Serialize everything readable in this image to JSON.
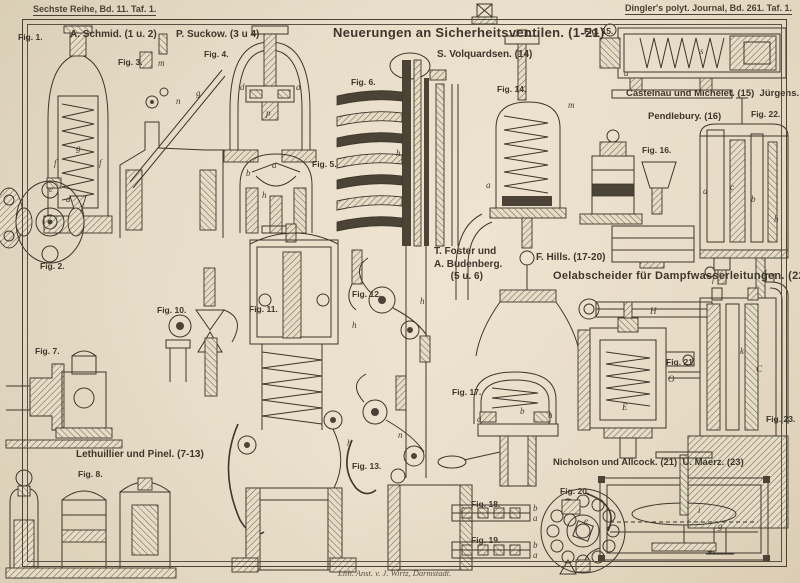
{
  "plate": {
    "margin": {
      "series_label": "Sechste Reihe, Bd. 11. Taf. 1.",
      "journal_label": "Dingler's polyt. Journal, Bd. 261. Taf. 1.",
      "credit": "Lith. Anst. v. J. Wirtz, Darmstadt."
    },
    "titles": [
      {
        "text": "Neuerungen an Sicherheitsventilen. (1-21)",
        "x": 333,
        "y": 25,
        "size": 13
      },
      {
        "text": "Oelabscheider für Dampfwasserleitungen. (22 u. 23)",
        "x": 553,
        "y": 270,
        "size": 11
      }
    ],
    "inventors": [
      {
        "text": "A. Schmid. (1 u. 2)",
        "x": 70,
        "y": 29
      },
      {
        "text": "P. Suckow. (3 u 4)",
        "x": 176,
        "y": 29
      },
      {
        "text": "S. Volquardsen. (14)",
        "x": 437,
        "y": 49
      },
      {
        "text": "Castelnau und Michelet. (15)  Jürgens. (22)",
        "x": 626,
        "y": 88,
        "size": 9.5
      },
      {
        "text": "Pendlebury. (16)",
        "x": 648,
        "y": 111,
        "size": 9.5
      },
      {
        "text": "T. Foster und\nA. Budenberg.\n      (5 u. 6)",
        "x": 434,
        "y": 246
      },
      {
        "text": "F. Hills. (17-20)",
        "x": 536,
        "y": 252
      },
      {
        "text": "Lethuillier und Pinel. (7-13)",
        "x": 76,
        "y": 449
      },
      {
        "text": "Nicholson und Allcock. (21)  U. Maerz. (23)",
        "x": 553,
        "y": 457,
        "size": 9.5
      }
    ],
    "figures": [
      {
        "text": "Fig. 1.",
        "x": 18,
        "y": 32
      },
      {
        "text": "Fig. 2.",
        "x": 40,
        "y": 261
      },
      {
        "text": "Fig. 3.",
        "x": 118,
        "y": 57
      },
      {
        "text": "Fig. 4.",
        "x": 204,
        "y": 49
      },
      {
        "text": "Fig. 5.",
        "x": 312,
        "y": 159
      },
      {
        "text": "Fig. 6.",
        "x": 351,
        "y": 77
      },
      {
        "text": "Fig. 7.",
        "x": 35,
        "y": 346
      },
      {
        "text": "Fig. 8.",
        "x": 78,
        "y": 469
      },
      {
        "text": "Fig. 10.",
        "x": 157,
        "y": 305
      },
      {
        "text": "Fig. 11.",
        "x": 249,
        "y": 304
      },
      {
        "text": "Fig. 12.",
        "x": 352,
        "y": 289
      },
      {
        "text": "Fig. 13.",
        "x": 352,
        "y": 461
      },
      {
        "text": "Fig. 14.",
        "x": 497,
        "y": 84
      },
      {
        "text": "Fig. 15.",
        "x": 584,
        "y": 26
      },
      {
        "text": "Fig. 16.",
        "x": 642,
        "y": 145
      },
      {
        "text": "Fig. 17.",
        "x": 452,
        "y": 387
      },
      {
        "text": "Fig. 18.",
        "x": 471,
        "y": 499
      },
      {
        "text": "Fig. 19.",
        "x": 471,
        "y": 535
      },
      {
        "text": "Fig. 20.",
        "x": 560,
        "y": 486
      },
      {
        "text": "Fig. 21.",
        "x": 666,
        "y": 357
      },
      {
        "text": "Fig. 22.",
        "x": 751,
        "y": 109
      },
      {
        "text": "Fig. 23.",
        "x": 766,
        "y": 414
      }
    ],
    "part_letters": [
      {
        "text": "g",
        "x": 76,
        "y": 143
      },
      {
        "text": "f",
        "x": 54,
        "y": 158
      },
      {
        "text": "f",
        "x": 99,
        "y": 158
      },
      {
        "text": "e",
        "x": 49,
        "y": 184
      },
      {
        "text": "d",
        "x": 66,
        "y": 194
      },
      {
        "text": "m",
        "x": 158,
        "y": 58
      },
      {
        "text": "n",
        "x": 176,
        "y": 96
      },
      {
        "text": "g",
        "x": 196,
        "y": 88
      },
      {
        "text": "d",
        "x": 240,
        "y": 82
      },
      {
        "text": "d",
        "x": 296,
        "y": 82
      },
      {
        "text": "p",
        "x": 266,
        "y": 108
      },
      {
        "text": "a",
        "x": 272,
        "y": 160
      },
      {
        "text": "b",
        "x": 246,
        "y": 168
      },
      {
        "text": "h",
        "x": 262,
        "y": 190
      },
      {
        "text": "h",
        "x": 396,
        "y": 148
      },
      {
        "text": "a",
        "x": 486,
        "y": 180
      },
      {
        "text": "s",
        "x": 700,
        "y": 46
      },
      {
        "text": "a",
        "x": 624,
        "y": 68
      },
      {
        "text": "m",
        "x": 568,
        "y": 100
      },
      {
        "text": "a",
        "x": 703,
        "y": 186
      },
      {
        "text": "c",
        "x": 730,
        "y": 182
      },
      {
        "text": "b",
        "x": 751,
        "y": 194
      },
      {
        "text": "h",
        "x": 774,
        "y": 214
      },
      {
        "text": "f",
        "x": 712,
        "y": 274
      },
      {
        "text": "d",
        "x": 762,
        "y": 268
      },
      {
        "text": "h",
        "x": 548,
        "y": 410
      },
      {
        "text": "a",
        "x": 477,
        "y": 414
      },
      {
        "text": "b",
        "x": 520,
        "y": 406
      },
      {
        "text": "h",
        "x": 352,
        "y": 320
      },
      {
        "text": "h",
        "x": 420,
        "y": 296
      },
      {
        "text": "n",
        "x": 398,
        "y": 430
      },
      {
        "text": "h",
        "x": 347,
        "y": 438
      },
      {
        "text": "H",
        "x": 650,
        "y": 306
      },
      {
        "text": "E",
        "x": 622,
        "y": 402
      },
      {
        "text": "O",
        "x": 668,
        "y": 374
      },
      {
        "text": "C",
        "x": 756,
        "y": 364
      },
      {
        "text": "k",
        "x": 740,
        "y": 346
      },
      {
        "text": "i",
        "x": 698,
        "y": 505
      },
      {
        "text": "e",
        "x": 584,
        "y": 516
      },
      {
        "text": "g",
        "x": 718,
        "y": 521
      },
      {
        "text": "b",
        "x": 533,
        "y": 503
      },
      {
        "text": "a",
        "x": 533,
        "y": 513
      },
      {
        "text": "b",
        "x": 533,
        "y": 540
      },
      {
        "text": "a",
        "x": 533,
        "y": 550
      }
    ]
  },
  "colors": {
    "paper": "#e8dfca",
    "ink": "#3d362b",
    "hatch": "#79705c",
    "dark_fill": "#4a4336"
  }
}
